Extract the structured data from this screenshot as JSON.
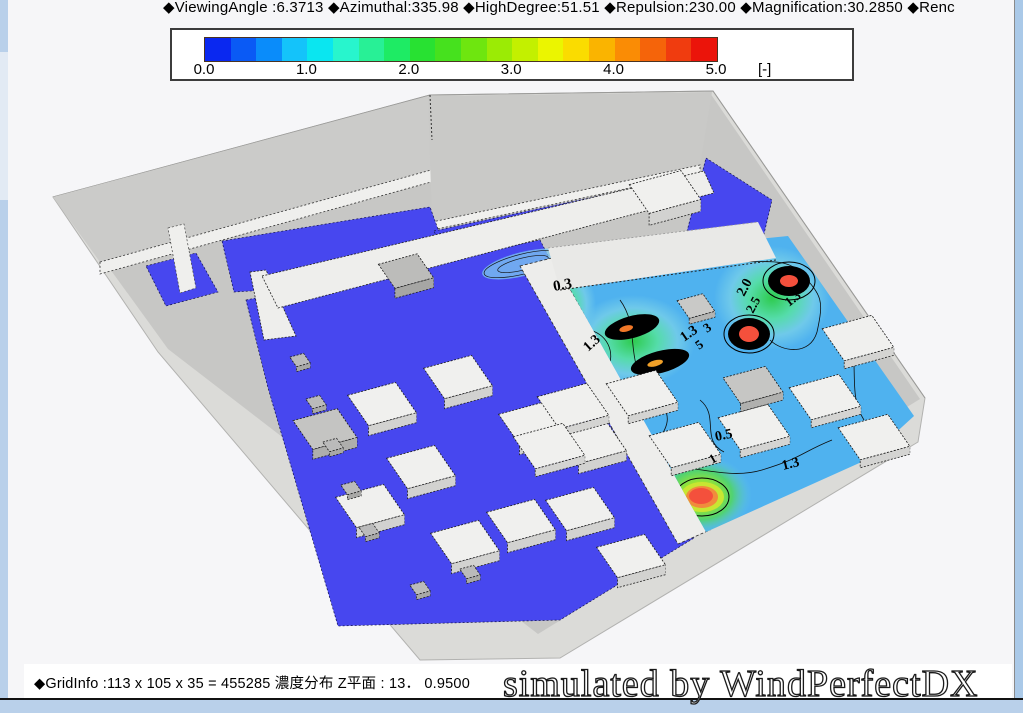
{
  "header": {
    "text": "◆ViewingAngle :6.3713  ◆Azimuthal:335.98  ◆HighDegree:51.51  ◆Repulsion:230.00  ◆Magnification:30.2850 ◆Renc"
  },
  "legend": {
    "ticks": [
      "0.0",
      "1.0",
      "2.0",
      "3.0",
      "4.0",
      "5.0"
    ],
    "unit": "[-]",
    "min": 0.0,
    "max": 5.0,
    "colors": [
      "#0a28f0",
      "#0a5af5",
      "#0a8cfa",
      "#14c3fa",
      "#0ae6f0",
      "#28f5cd",
      "#28f096",
      "#1eeb64",
      "#28e132",
      "#46e11e",
      "#6ee60f",
      "#9beb05",
      "#c3f000",
      "#ebf500",
      "#fadc00",
      "#fab400",
      "#fa8c05",
      "#f5640a",
      "#f03c0f",
      "#eb140a"
    ]
  },
  "scene": {
    "contour_labels": [
      {
        "value": "0.3",
        "x": 554,
        "y": 291,
        "rot": -10,
        "size": 15
      },
      {
        "value": "1.3",
        "x": 588,
        "y": 352,
        "rot": -42,
        "size": 14
      },
      {
        "value": "1.3",
        "x": 684,
        "y": 342,
        "rot": -35,
        "size": 14
      },
      {
        "value": "5",
        "x": 699,
        "y": 350,
        "rot": -35,
        "size": 13
      },
      {
        "value": "3",
        "x": 707,
        "y": 333,
        "rot": -35,
        "size": 13
      },
      {
        "value": "2.0",
        "x": 744,
        "y": 297,
        "rot": -62,
        "size": 14
      },
      {
        "value": "2.5",
        "x": 753,
        "y": 314,
        "rot": -62,
        "size": 13
      },
      {
        "value": "1.3",
        "x": 789,
        "y": 307,
        "rot": -38,
        "size": 13
      },
      {
        "value": "0.5",
        "x": 716,
        "y": 441,
        "rot": -12,
        "size": 14
      },
      {
        "value": "1",
        "x": 712,
        "y": 464,
        "rot": -30,
        "size": 13
      },
      {
        "value": "1.3",
        "x": 783,
        "y": 470,
        "rot": -14,
        "size": 14
      }
    ]
  },
  "footer": {
    "grid_info": "◆GridInfo :113 x 105 x 35 = 455285 濃度分布 Z平面 : 13． 0.9500",
    "watermark": "simulated by WindPerfectDX"
  }
}
